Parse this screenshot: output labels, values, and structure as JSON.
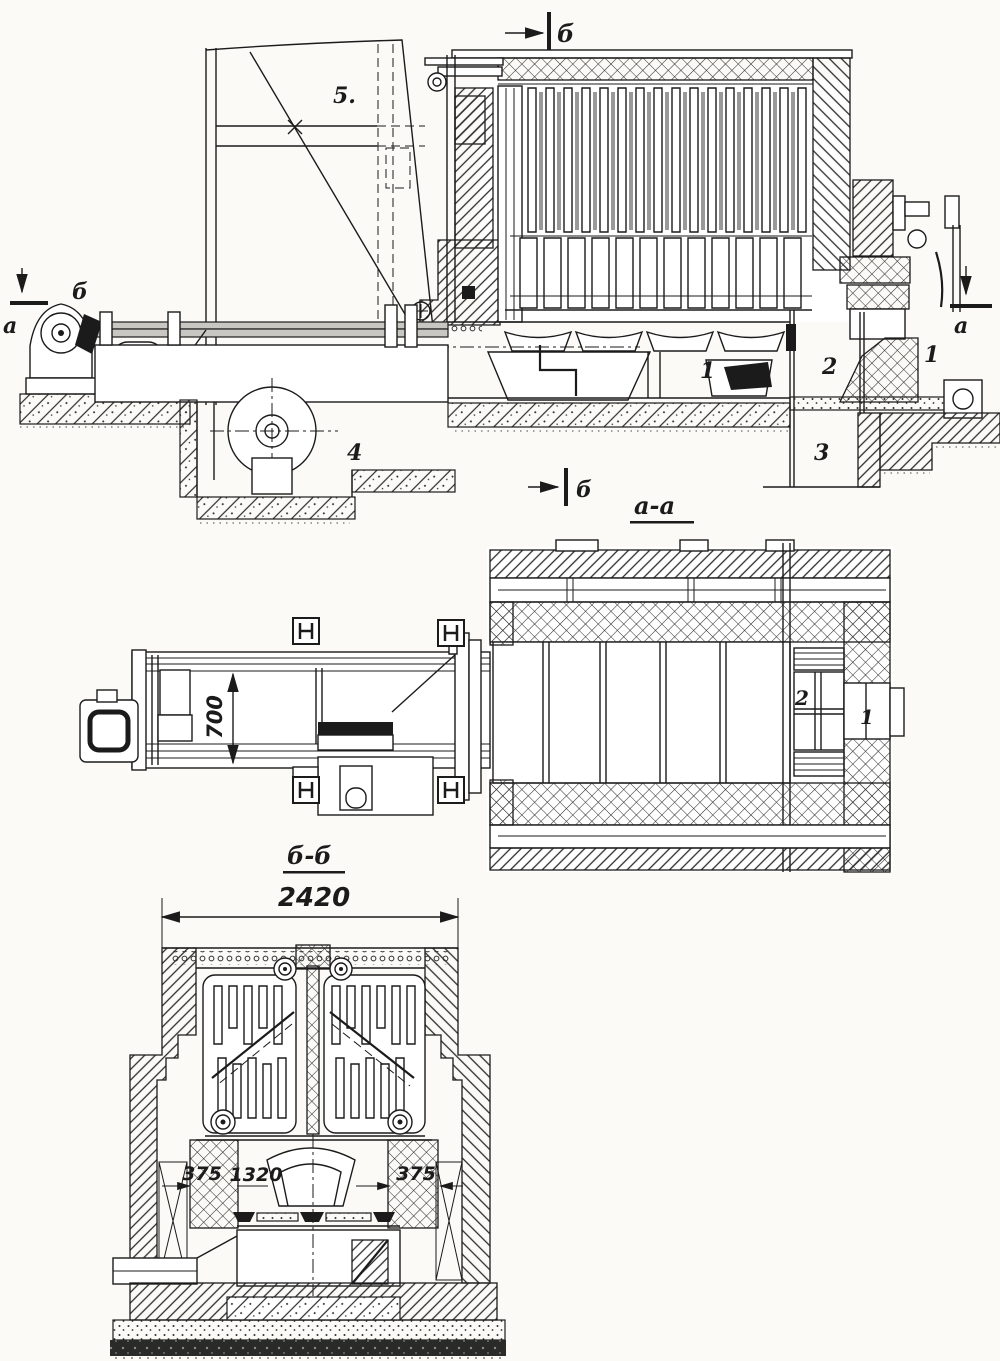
{
  "figure": {
    "type": "technical-drawing",
    "description": "Furnace installation: side sectional elevation, plan section and cross section with charging conveyor",
    "ink_color": "#1b1b1b",
    "paper_color": "#fbfaf7"
  },
  "side_view": {
    "marker_b_top": "б",
    "marker_b_left": "б",
    "marker_a_left": "а",
    "marker_a_right": "а",
    "marker_b_bottom": "б",
    "part_5": "5.",
    "part_4": "4",
    "part_1": "1",
    "part_2": "2",
    "part_3": "3",
    "part_1_door": "1",
    "plan_title": "а-а"
  },
  "plan_view": {
    "dim_width": "700",
    "part_2": "2",
    "part_1": "1",
    "cross_title": "б-б"
  },
  "cross_section": {
    "dim_total_width": "2420",
    "dim_left_pier": "375",
    "dim_hearth": "1320",
    "dim_right_pier": "375"
  }
}
